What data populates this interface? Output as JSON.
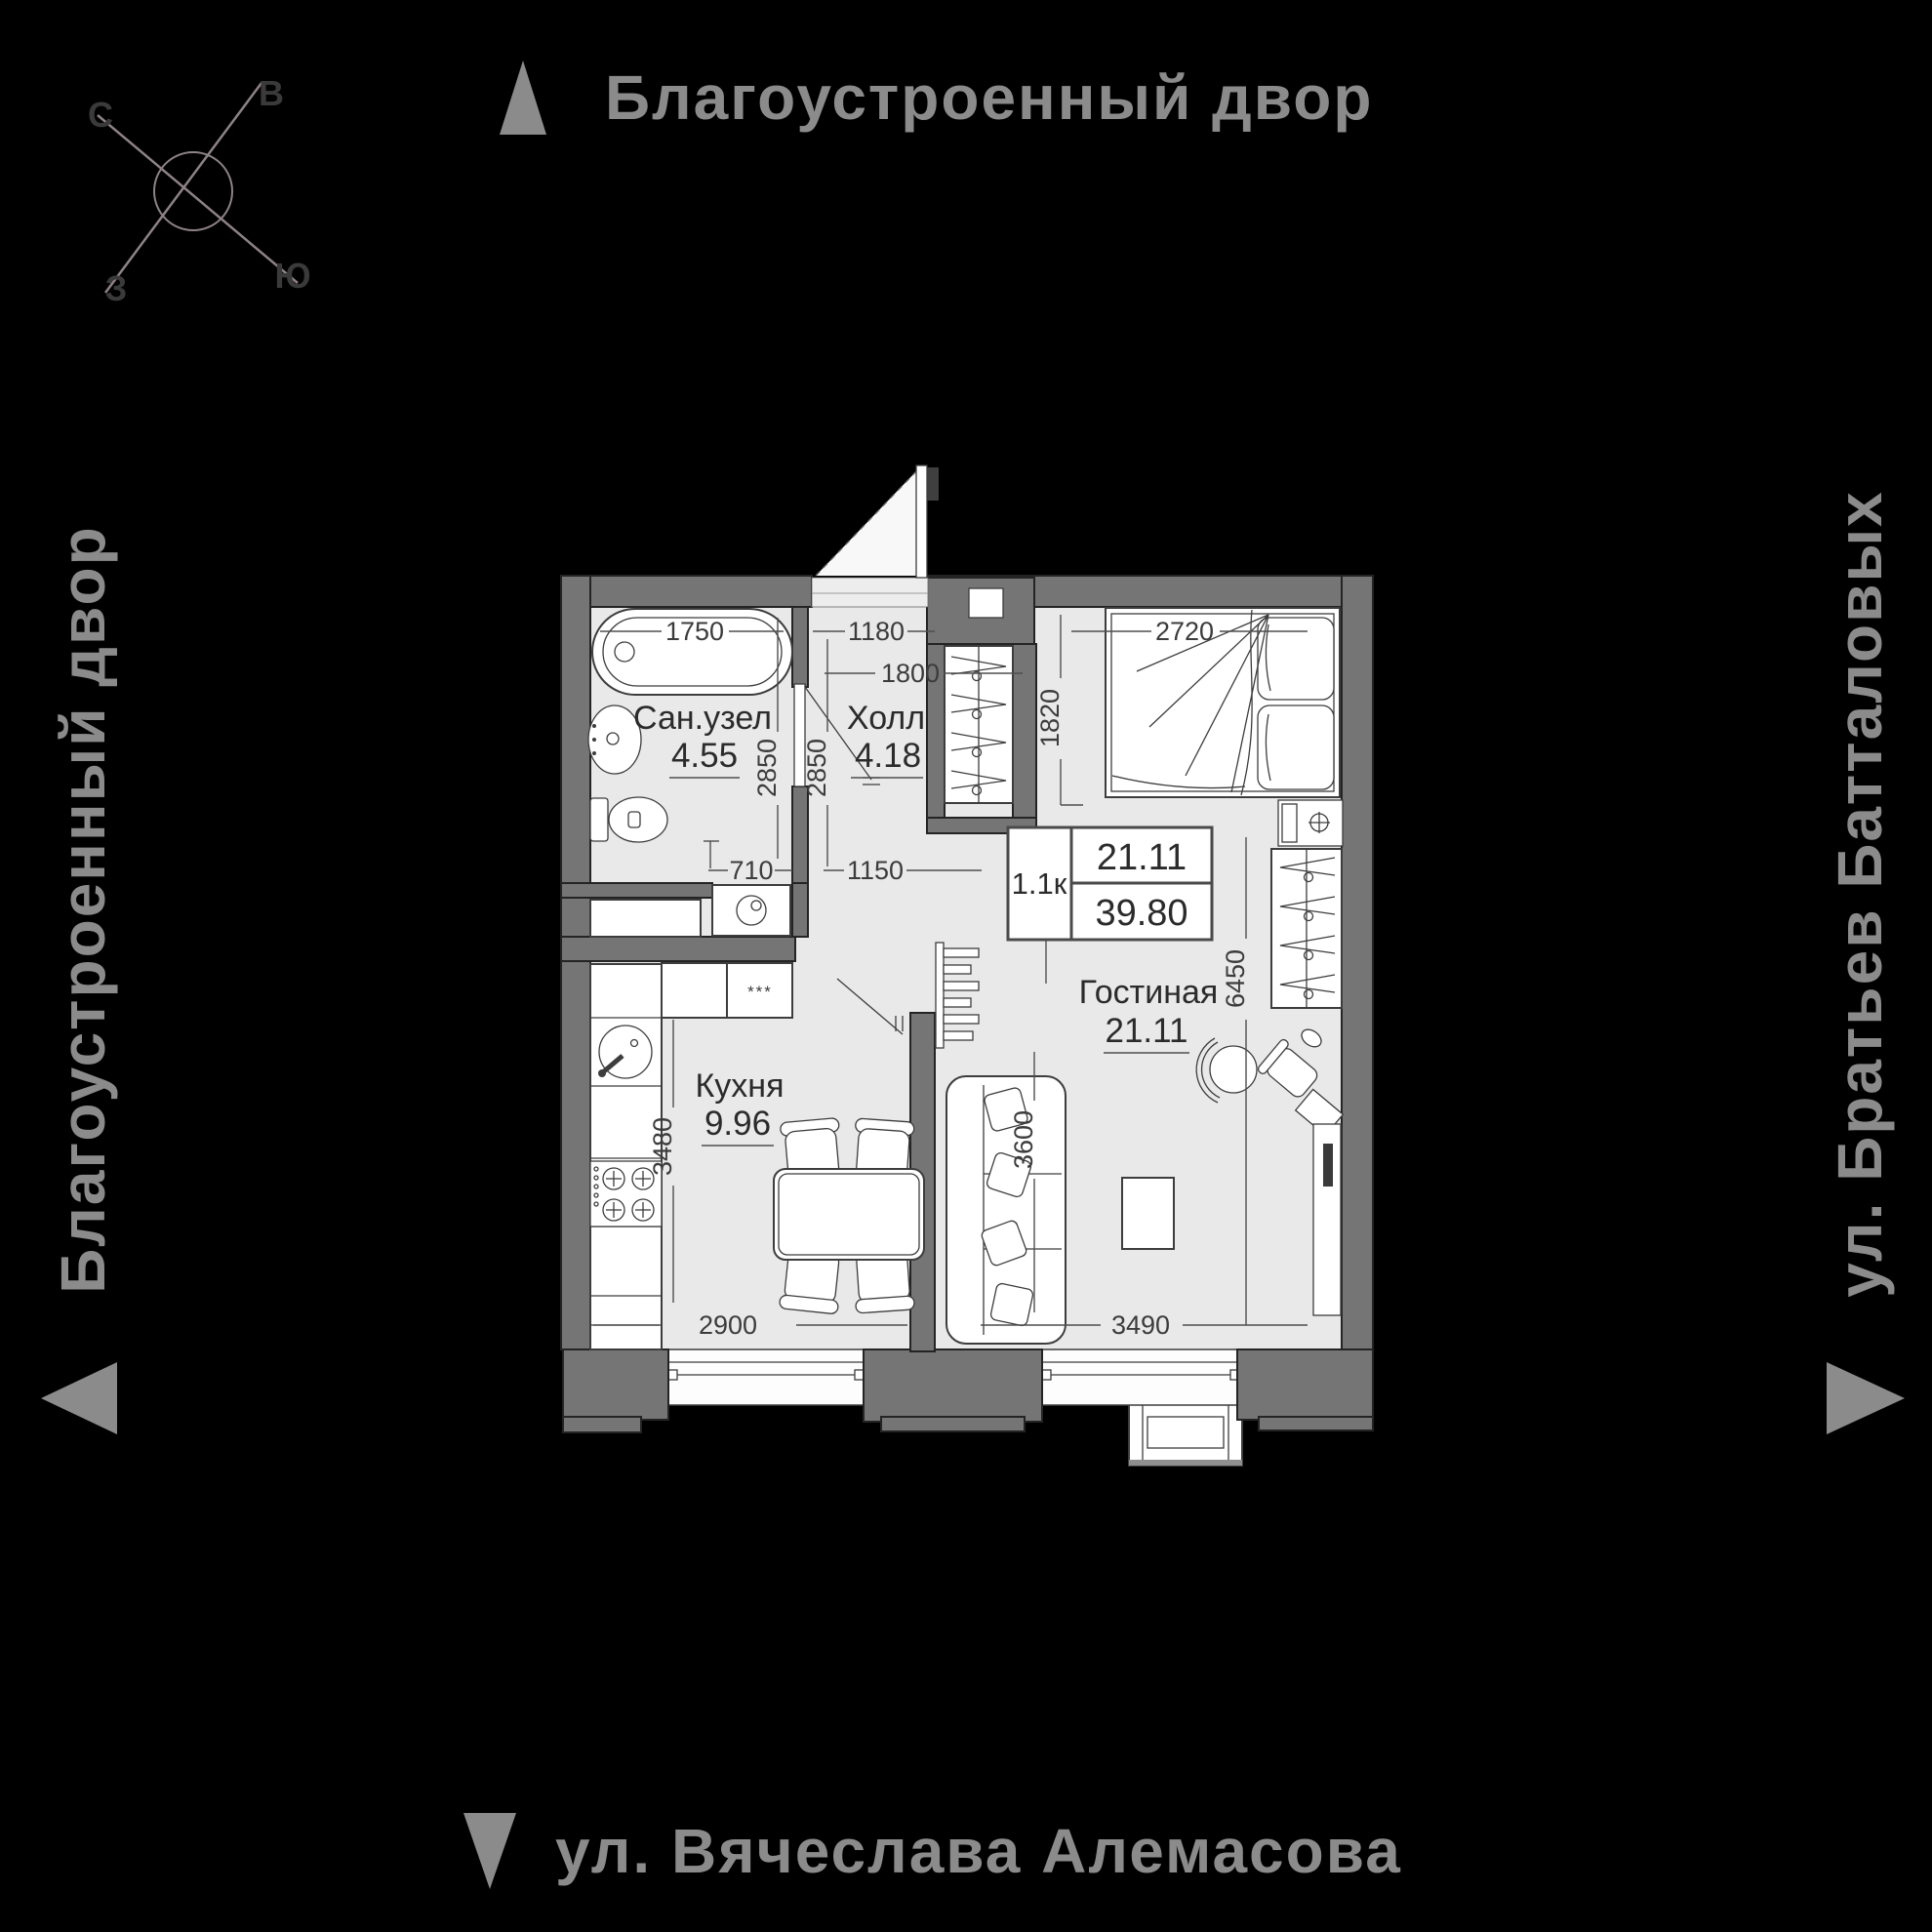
{
  "colors": {
    "background": "#000000",
    "street_label": "#8b8b8b",
    "wall": "#757575",
    "floor": "#e9e9e9",
    "outline": "#3d3d3d",
    "text": "#2b2b2b",
    "compass_line": "#8d8287"
  },
  "compass": {
    "north": "С",
    "east": "В",
    "west": "З",
    "south": "Ю"
  },
  "streets": {
    "top": "Благоустроенный двор",
    "left": "Благоустроенный двор",
    "right": "ул. Братьев Батталовых",
    "bottom": "ул. Вячеслава Алемасова"
  },
  "info_box": {
    "type": "1.1к",
    "living_area": "21.11",
    "total_area": "39.80"
  },
  "rooms": {
    "bathroom": {
      "name": "Сан.узел",
      "area": "4.55"
    },
    "hall": {
      "name": "Холл",
      "area": "4.18"
    },
    "kitchen": {
      "name": "Кухня",
      "area": "9.96"
    },
    "living": {
      "name": "Гостиная",
      "area": "21.11"
    }
  },
  "dimensions": {
    "bathtub": "1750",
    "hall_top": "1180",
    "hall_inner": "1800",
    "bathroom_depth": "2850",
    "hall_depth": "2850",
    "bath_bottom": "710",
    "hall_bottom": "1150",
    "bed_width": "2720",
    "bed_side": "1820",
    "kitchen_depth": "3480",
    "kitchen_width": "2900",
    "sofa_side": "3600",
    "living_width": "3490",
    "living_length": "6450"
  },
  "labels": {
    "cabinet": "***"
  }
}
